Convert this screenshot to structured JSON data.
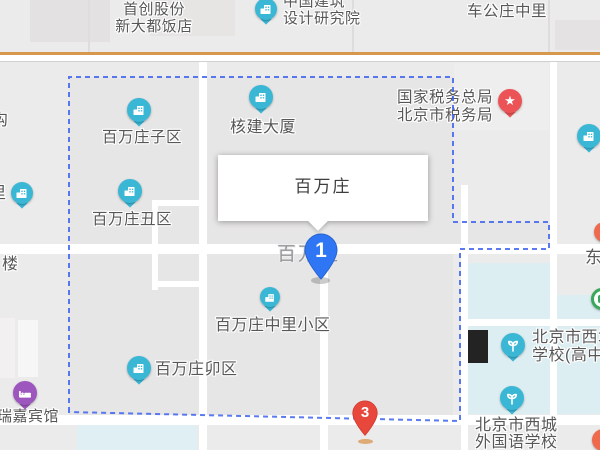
{
  "map": {
    "popup": {
      "title": "百万庄"
    },
    "pins": [
      {
        "number": "1"
      },
      {
        "number": "3"
      }
    ],
    "road_label": "百万庄",
    "poi_labels": {
      "shouchuang": [
        "首创股份",
        "新大都饭店"
      ],
      "sheji_yuan": [
        "中国建筑",
        "设计研究院"
      ],
      "chegongzhuang_zhongli": "车公庄中里",
      "shuiwu_ju": [
        "国家税务总局",
        "北京市税务局"
      ],
      "hejian_dasha": "核建大厦",
      "baiwanzhuang_ziqu": "百万庄子区",
      "baiwanzhuang_chouqu": "百万庄丑区",
      "baiwanzhuang_maoqu": "百万庄卯区",
      "baiwanzhuang_zhongli": "百万庄中里小区",
      "ruijia_hotel": "瑞嘉宾馆",
      "xicheng_gaozhong": [
        "北京市西城",
        "学校(高中部"
      ],
      "xicheng_waiguoyu": [
        "北京市西城",
        "外国语学校"
      ],
      "dong": "东",
      "gou": "沟",
      "lou": "楼",
      "li": "里"
    },
    "icons": {
      "building_marker": "building-icon",
      "school_marker": "sprout-icon",
      "hotel_marker": "bed-icon",
      "tax_marker": "star-icon",
      "star_glyph": "★"
    },
    "colors": {
      "marker_teal": "#3bb7d6",
      "marker_purple": "#9d56bd",
      "marker_red": "#ec5357",
      "pin_blue": "#2f76f4",
      "pin_red": "#e8473c",
      "boundary_blue": "#3e63ee",
      "road_casing_orange": "#d6984c",
      "school_zone_blue": "#ddeef3"
    }
  }
}
